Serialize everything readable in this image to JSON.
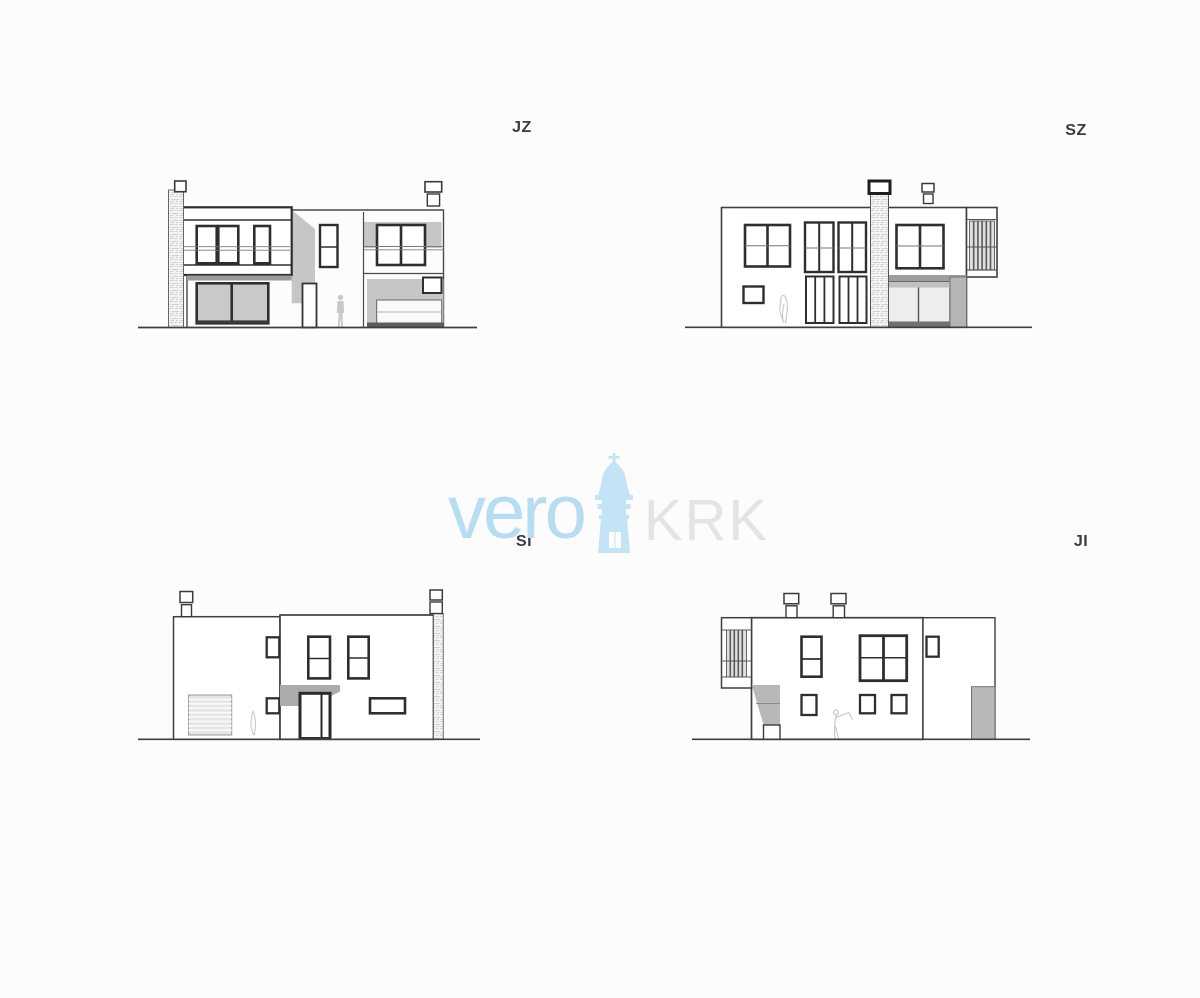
{
  "sheet": {
    "background": "#fcfcfc",
    "description_labels_visible": [
      "JZ",
      "SZ",
      "SI",
      "JI"
    ]
  },
  "elevations": [
    {
      "id": "jz",
      "label": "JZ"
    },
    {
      "id": "sz",
      "label": "SZ"
    },
    {
      "id": "si",
      "label": "SI"
    },
    {
      "id": "ji",
      "label": "JI"
    }
  ],
  "watermark": {
    "word_left": "vero",
    "word_right": "KRK",
    "tower_icon": "church-tower-icon",
    "color_word_left": "#b7ddf2",
    "color_word_right": "#e4e4e4",
    "color_tower": "#c2e4f6"
  },
  "colors": {
    "line": "#3f3f3f",
    "window_frame": "#2e2e2e",
    "shadow_gray": "#c6c6c6",
    "glass_gray": "#c9c9c9",
    "soffit_dark": "#9a9a9a",
    "pillar_gray": "#b5b5b5",
    "stone_base": "#f4f4f4",
    "stone_marks": "#c6c6c6",
    "label_text": "#3b3b3b"
  }
}
